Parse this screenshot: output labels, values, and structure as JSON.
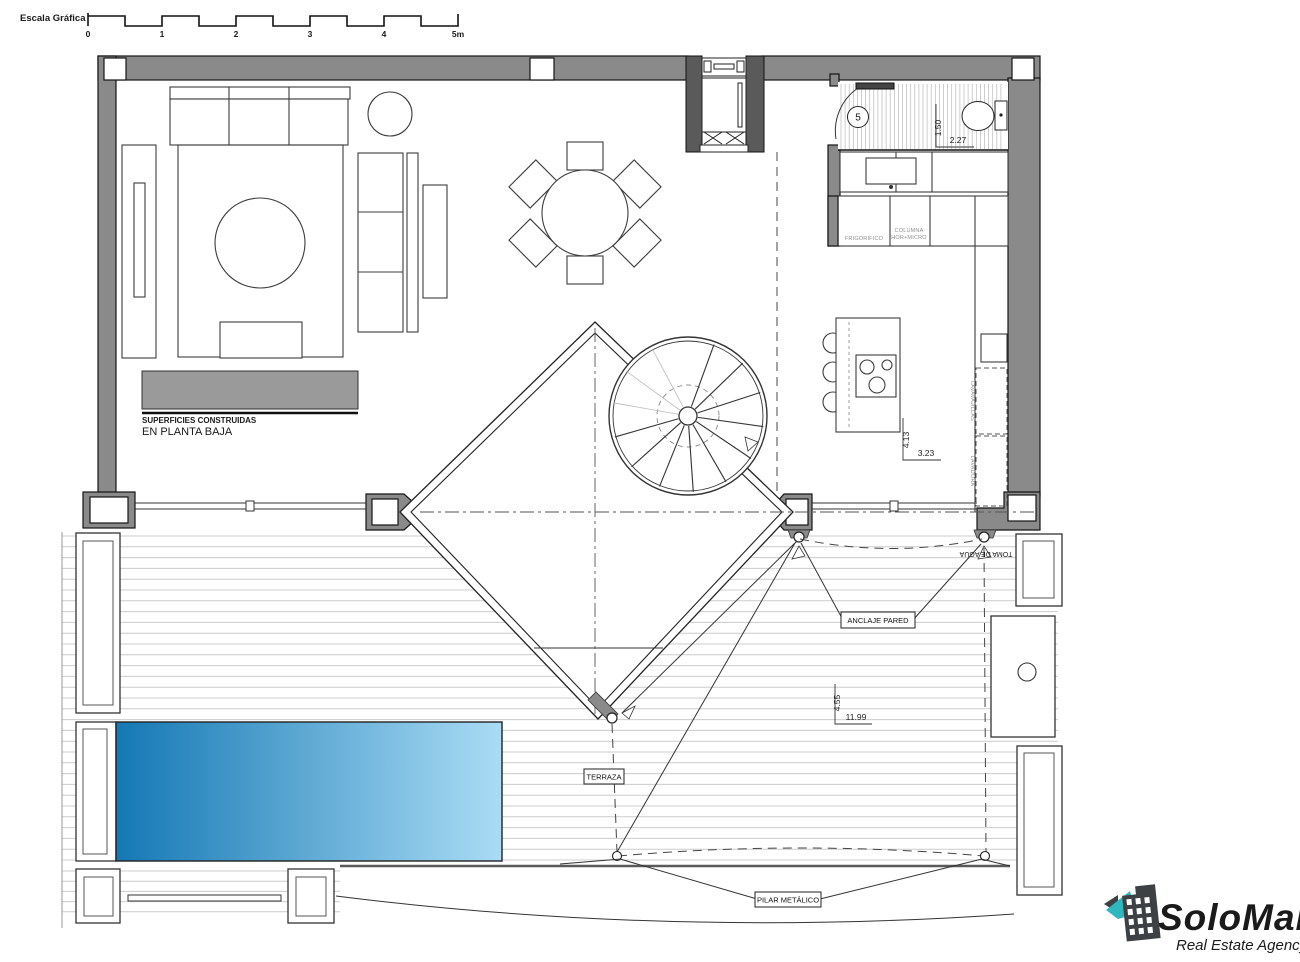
{
  "scale_bar": {
    "title": "Escala Gráfica",
    "ticks": [
      "0",
      "1",
      "2",
      "3",
      "4",
      "5m"
    ]
  },
  "plan_labels": {
    "superficies_line1": "SUPERFICIES CONSTRUIDAS",
    "superficies_line2": "EN PLANTA BAJA",
    "room_number": "5",
    "frigorifico": "FRIGORIFICO",
    "columna_line1": "COLUMNA",
    "columna_line2": "HOR+MICRO",
    "lavavajillas": "LAVAVAJILLAS",
    "lavadora": "LAVADORA",
    "toma_de_agua": "TOMA DE AGUA",
    "anclaje_pared": "ANCLAJE PARED",
    "terraza": "TERRAZA",
    "pilar_metalico": "PILAR METÁLICO"
  },
  "dimensions": {
    "bath_width": "1.50",
    "bath_length": "2.27",
    "kitchen_width": "4.13",
    "kitchen_length": "3.23",
    "terrace_width": "4.55",
    "terrace_length": "11.99"
  },
  "logo": {
    "name": "SoloMar",
    "tagline": "Real Estate Agency",
    "teal": "#2fb7bf",
    "dark": "#3d4144"
  },
  "colors": {
    "wall_gray": "#8a8a8a",
    "sideboard_gray": "#9a9a9a",
    "pool_dark": "#1478b4",
    "pool_light": "#aadcf5",
    "deck_line": "#cccccc",
    "hatch_line": "#b9b9b9"
  }
}
